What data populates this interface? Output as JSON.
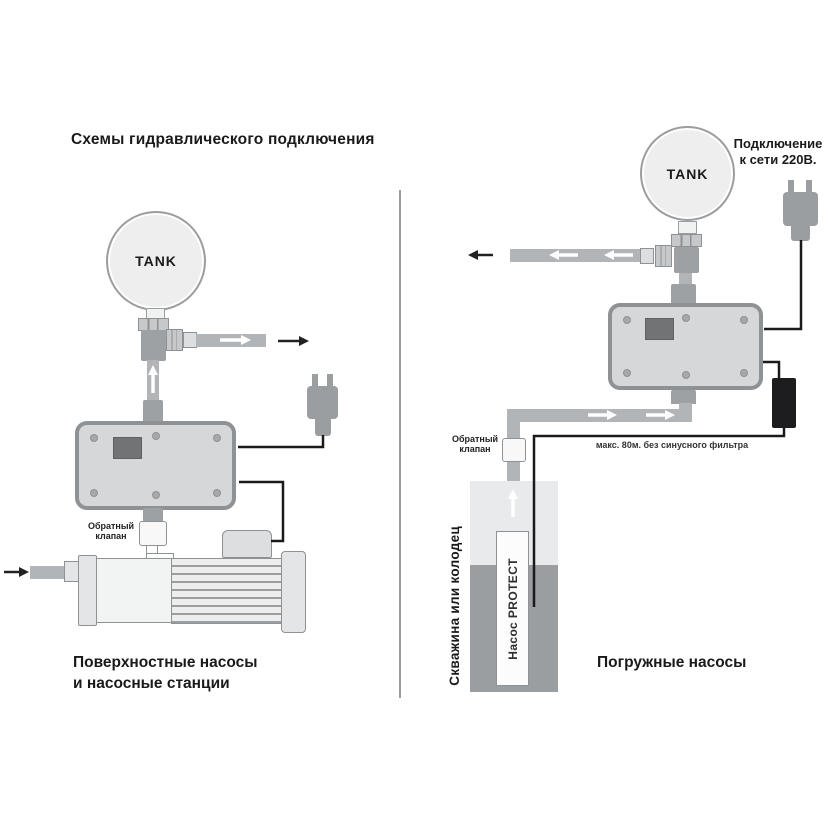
{
  "title": "Схемы гидравлического подключения",
  "left": {
    "tank_label": "TANK",
    "check_valve_label": "Обратный клапан",
    "caption_line1": "Поверхностные насосы",
    "caption_line2": "и насосные станции"
  },
  "right": {
    "tank_label": "TANK",
    "check_valve_label": "Обратный клапан",
    "power_line1": "Подключение",
    "power_line2": "к сети 220В.",
    "cable_note": "макс. 80м. без синусного фильтра",
    "well_label": "Скважина или колодец",
    "pump_label": "Насос PROTECT",
    "caption": "Погружные насосы"
  },
  "colors": {
    "pipe": "#b2b5b7",
    "pipe_dark": "#9ea1a3",
    "device_fill": "#d6d7d8",
    "device_border": "#8f9295",
    "display": "#717375",
    "tank_fill": "#eeeeef",
    "plug": "#9b9ea0",
    "wire": "#1a1a1c",
    "well_top": "#e9eaeb",
    "well_water": "#9b9ea0",
    "text": "#1a1a1a"
  }
}
